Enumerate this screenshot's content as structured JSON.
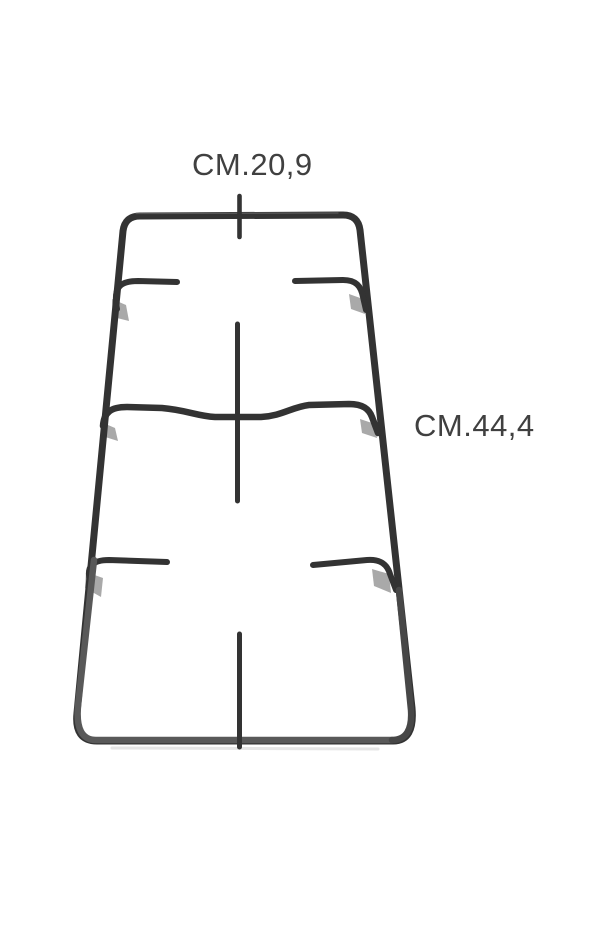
{
  "page": {
    "background_color": "#ffffff",
    "description": "Product photo of a two-burner gas hob pan support grid viewed in perspective on a white background, annotated with overall dimensions"
  },
  "figure": {
    "subject": "pan-support-grid",
    "wire_color": "#333333",
    "lower_frame_color": "#595959",
    "lower_right_frame_color": "#474747",
    "joint_shadow_color": "#949494",
    "ground_shadow_color": "#d8d8d8",
    "top_highlight_color": "#777777"
  },
  "annotations": {
    "label_color": "#404040",
    "width_label": {
      "text": "CM.20,9"
    },
    "length_label": {
      "text": "CM.44,4"
    }
  }
}
